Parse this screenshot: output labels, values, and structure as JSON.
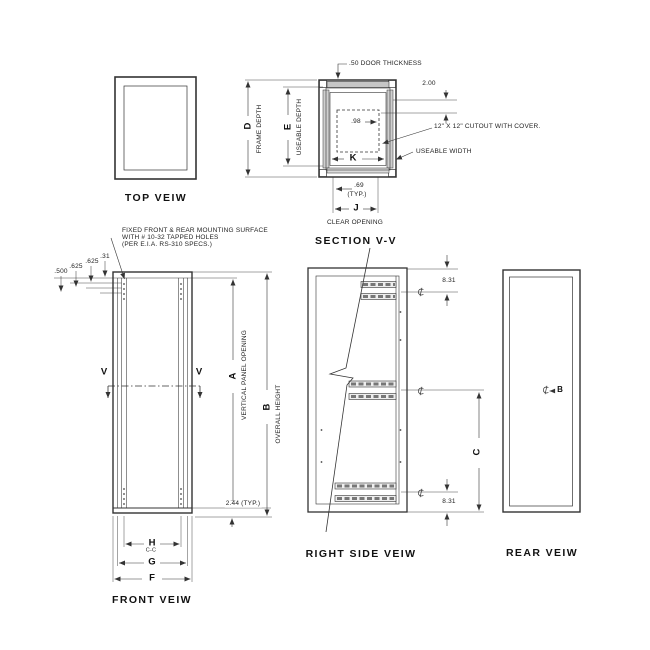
{
  "drawing": {
    "top_view": {
      "title": "TOP VEIW"
    },
    "section_view": {
      "title": "SECTION V-V",
      "door_thickness": ".50 DOOR THICKNESS",
      "dim_top_offset": "2.00",
      "dim_cutout_offset": ".98",
      "cutout_note": "12\" X 12\" CUTOUT WITH COVER.",
      "useable_width": "USEABLE WIDTH",
      "dim_d": "D",
      "frame_depth": "FRAME DEPTH",
      "dim_e": "E",
      "useable_depth": "USEABLE DEPTH",
      "dim_k": "K",
      "dim_side_gap": ".69",
      "typ": "(TYP.)",
      "dim_j": "J",
      "clear_opening": "CLEAR OPENING"
    },
    "front_view": {
      "title": "FRONT VEIW",
      "note_line1": "FIXED FRONT & REAR MOUNTING SURFACE",
      "note_line2": "WITH # 10-32 TAPPED HOLES",
      "note_line3": "(PER E.I.A. RS-310 SPECS.)",
      "dim_500": ".500",
      "dim_625a": ".625",
      "dim_625b": ".625",
      "dim_31": ".31",
      "section_cut_left": "V",
      "section_cut_right": "V",
      "dim_a": "A",
      "vertical_panel_opening": "VERTICAL PANEL OPENING",
      "dim_b": "B",
      "overall_height": "OVERALL HEIGHT",
      "dim_bottom": "2.44 (TYP.)",
      "dim_h": "H",
      "dim_h_sub": "C-C",
      "dim_g": "G",
      "dim_f": "F"
    },
    "right_side_view": {
      "title": "RIGHT SIDE VEIW",
      "dim_top": "8.31",
      "dim_bottom": "8.31",
      "dim_c": "C"
    },
    "rear_view": {
      "title": "REAR VEIW",
      "dim_b": "B"
    },
    "icons": {
      "centerline": "centerline-symbol"
    }
  }
}
